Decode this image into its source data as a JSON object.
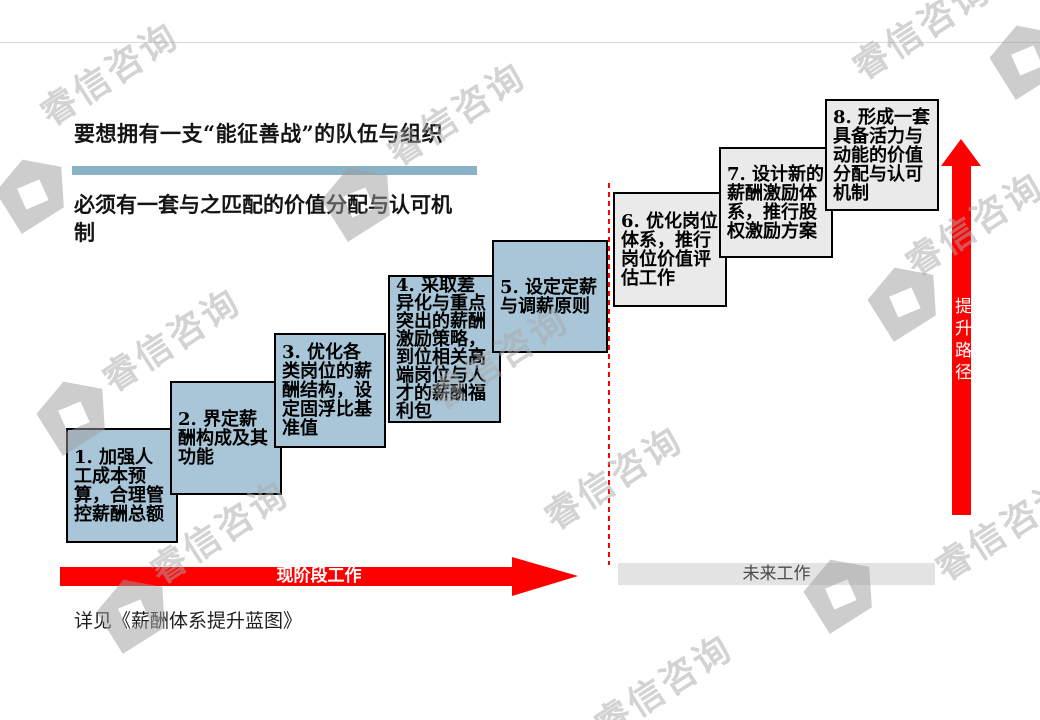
{
  "page": {
    "title": "要想拥有一支“能征善战”的队伍与组织",
    "subtitle": "必须有一套与之匹配的价值分配与认可机制",
    "footer_note": "详见《薪酬体系提升蓝图》"
  },
  "steps": [
    {
      "label": "1. 加强人工成本预算，合理管控薪酬总额",
      "phase": "current"
    },
    {
      "label": "2. 界定薪酬构成及其功能",
      "phase": "current"
    },
    {
      "label": "3. 优化各类岗位的薪酬结构，设定固浮比基准值",
      "phase": "current"
    },
    {
      "label": "4. 采取差异化与重点突出的薪酬激励策略，到位相关高端岗位与人才的薪酬福利包",
      "phase": "current"
    },
    {
      "label": "5. 设定定薪与调薪原则",
      "phase": "current"
    },
    {
      "label": "6. 优化岗位体系，推行岗位价值评估工作",
      "phase": "future"
    },
    {
      "label": "7. 设计新的薪酬激励体系，推行股权激励方案",
      "phase": "future"
    },
    {
      "label": "8. 形成一套具备活力与动能的价值分配与认可机制",
      "phase": "future"
    }
  ],
  "timeline": {
    "current_phase_label": "现阶段工作",
    "future_phase_label": "未来工作"
  },
  "path_arrow_label": "提升路径",
  "watermark": {
    "text": "睿信咨询"
  },
  "colors": {
    "step_current_fill": "#a8c6d8",
    "step_future_fill": "#eaeaea",
    "accent_bar": "#8ab2c7",
    "arrow_red": "#fe0000",
    "future_bar_fill": "#e3e3e3"
  }
}
